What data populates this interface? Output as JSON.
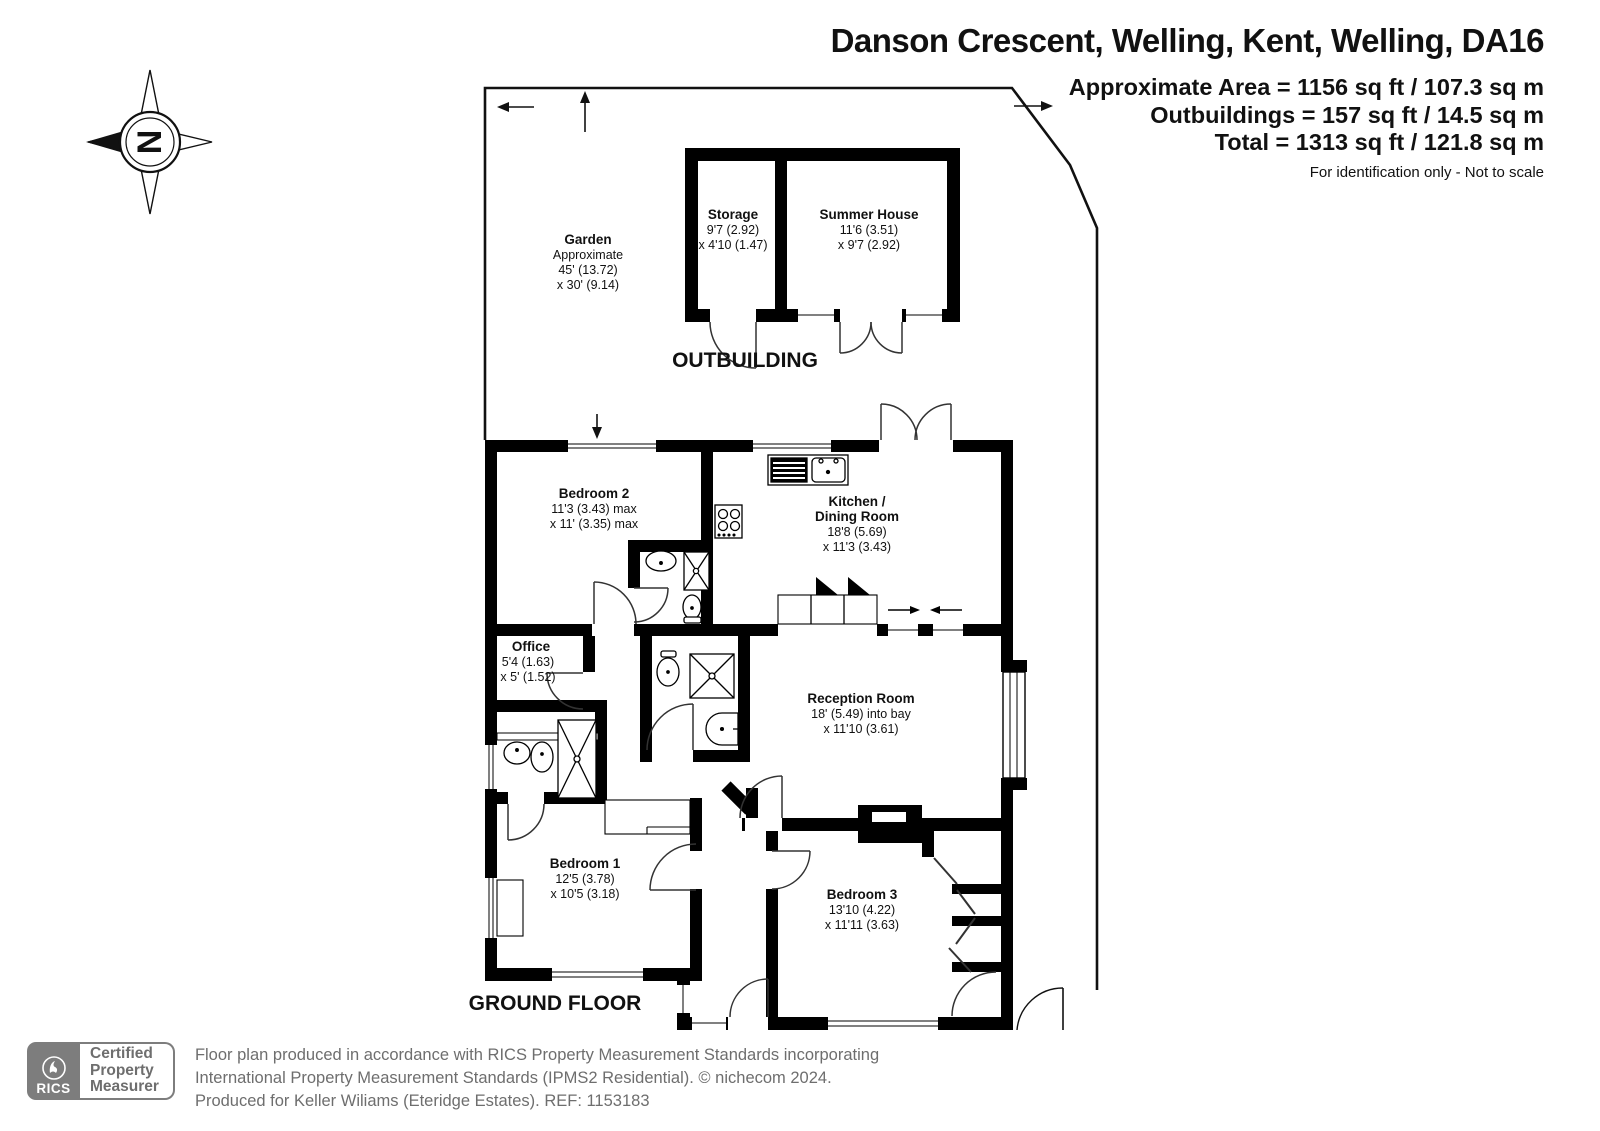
{
  "header": {
    "title": "Danson Crescent, Welling, Kent, Welling, DA16",
    "area_line1": "Approximate Area = 1156 sq ft / 107.3 sq m",
    "area_line2": "Outbuildings = 157 sq ft / 14.5 sq m",
    "area_line3": "Total = 1313 sq ft / 121.8 sq m",
    "disclaimer": "For identification only - Not to scale"
  },
  "compass": {
    "north_letter": "N"
  },
  "plan": {
    "outbuilding_label": "OUTBUILDING",
    "ground_floor_label": "GROUND FLOOR",
    "garden": {
      "name": "Garden",
      "note": "Approximate",
      "dim1": "45' (13.72)",
      "dim2": "x 30' (9.14)"
    },
    "storage": {
      "name": "Storage",
      "dim1": "9'7 (2.92)",
      "dim2": "x 4'10 (1.47)"
    },
    "summer_house": {
      "name": "Summer House",
      "dim1": "11'6 (3.51)",
      "dim2": "x 9'7 (2.92)"
    },
    "bedroom2": {
      "name": "Bedroom 2",
      "dim1": "11'3 (3.43) max",
      "dim2": "x 11' (3.35) max"
    },
    "kitchen": {
      "name_line1": "Kitchen /",
      "name_line2": "Dining Room",
      "dim1": "18'8 (5.69)",
      "dim2": "x 11'3 (3.43)"
    },
    "office": {
      "name": "Office",
      "dim1": "5'4 (1.63)",
      "dim2": "x 5' (1.52)"
    },
    "reception": {
      "name": "Reception Room",
      "dim1": "18' (5.49) into bay",
      "dim2": "x 11'10 (3.61)"
    },
    "bedroom1": {
      "name": "Bedroom 1",
      "dim1": "12'5 (3.78)",
      "dim2": "x 10'5 (3.18)"
    },
    "bedroom3": {
      "name": "Bedroom 3",
      "dim1": "13'10 (4.22)",
      "dim2": "x 11'11 (3.63)"
    }
  },
  "footer": {
    "rics_label": "RICS",
    "badge_line1": "Certified",
    "badge_line2": "Property",
    "badge_line3": "Measurer",
    "line1": "Floor plan produced in accordance with RICS Property Measurement Standards incorporating",
    "line2": "International Property Measurement Standards (IPMS2 Residential).  © nichecom 2024.",
    "line3": "Produced for Keller Wiliams (Eteridge Estates).   REF: 1153183"
  },
  "colors": {
    "wall": "#000000",
    "footer_gray": "#757575"
  }
}
